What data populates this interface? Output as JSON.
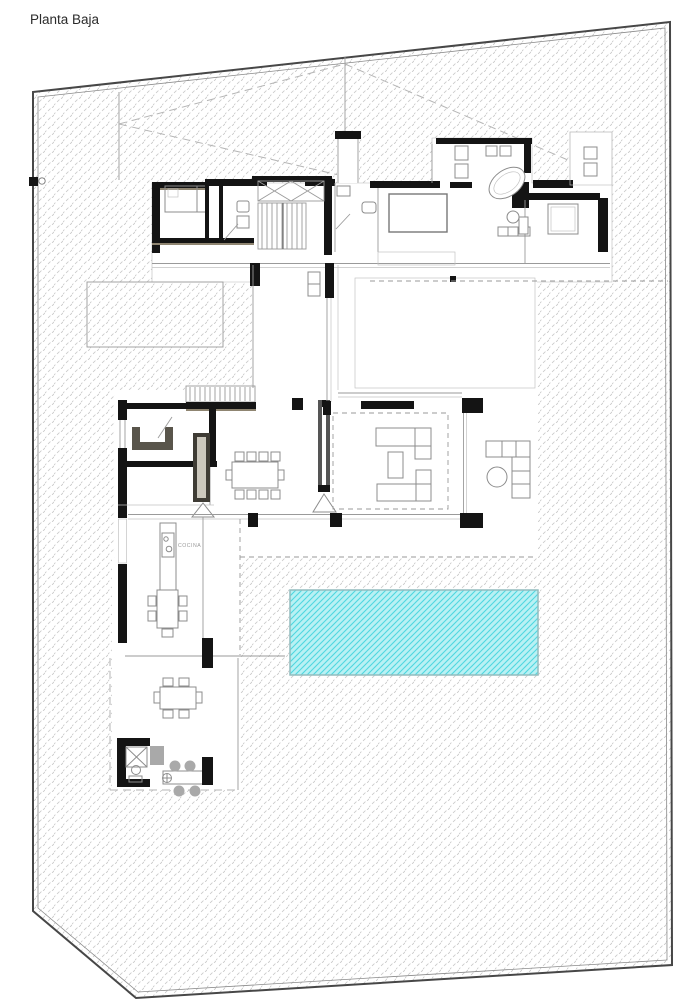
{
  "title": "Planta Baja",
  "labels": {
    "kitchen": "COCINA"
  },
  "colors": {
    "wall": "#141414",
    "wood": "#8f8571",
    "furn": "#8c8c8c",
    "line": "#9a9a9a",
    "grayfill": "#a9a9a9",
    "text": "#2b2b2b",
    "label": "#9a9a9a",
    "hatch": "#c9c9c9",
    "pool": "#b9f1f4",
    "poolline": "#4ed7e0",
    "boundary": "#474747"
  },
  "plan": {
    "floor_name": "Planta Baja",
    "site": "irregular lot, double-line boundary, diagonal hatch ground",
    "pool": {
      "shape": "rectangle",
      "pattern": "cyan water hatch"
    },
    "features": [
      "carport-ramp-markings",
      "entry-walkway",
      "bedroom-bed",
      "walkin-closet",
      "interior-staircase",
      "void-cross",
      "ensuite-bathtub",
      "double-sink",
      "wc-fixtures",
      "guest-bedroom-bed",
      "corridor",
      "planter-bed",
      "entry-steps",
      "utility-u-room",
      "kitchen-tall-units",
      "kitchen-island",
      "dining-table-8",
      "living-sofa-set",
      "area-rug-dashed",
      "outdoor-lounge-set",
      "terrace",
      "swimming-pool",
      "outdoor-dining-table-6",
      "barbecue-counter",
      "bar-stools",
      "deck"
    ]
  }
}
